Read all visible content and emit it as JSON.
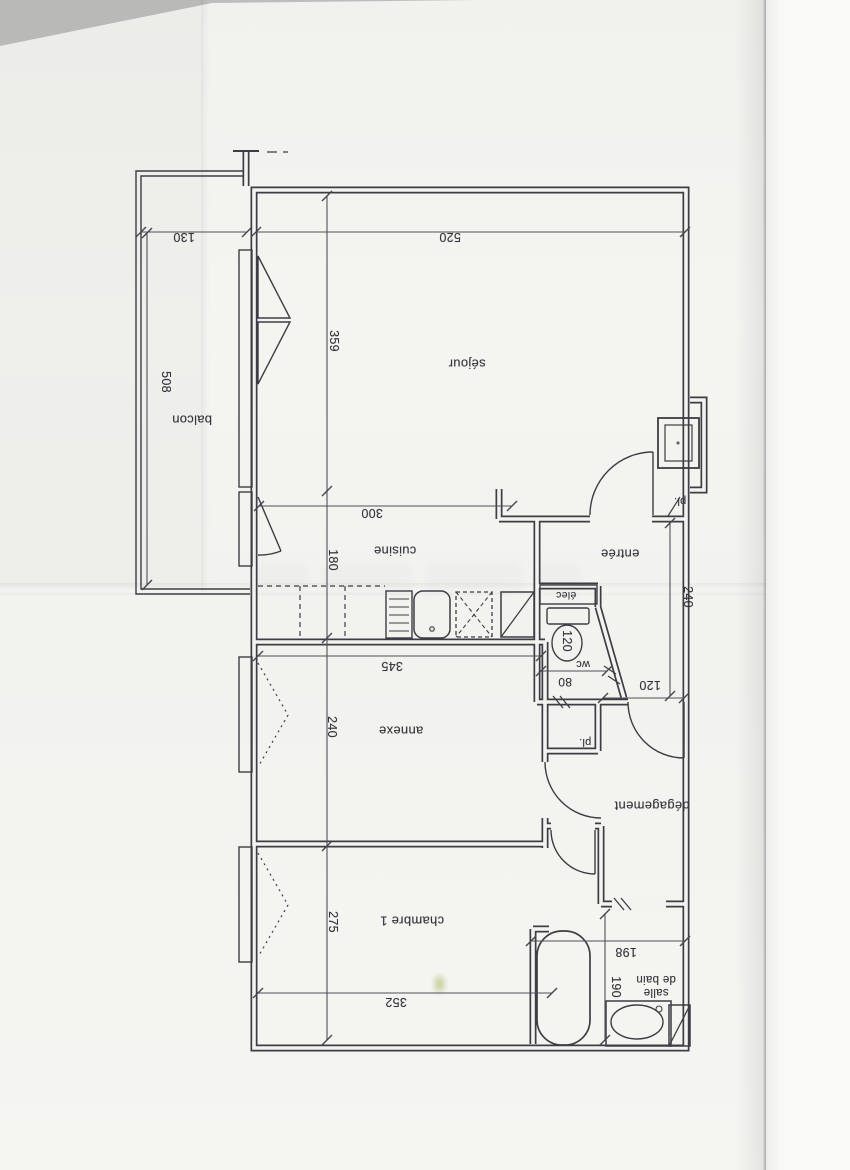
{
  "rooms": {
    "sejour": "séjour",
    "balcon": "balcon",
    "cuisine": "cuisine",
    "entree": "entrée",
    "annexe": "annexe",
    "degagement": "dégagement",
    "chambre1": "chambre 1",
    "salle_de_bain_line1": "salle",
    "salle_de_bain_line2": "de bain",
    "wc": "wc",
    "elec": "élec",
    "placard_entree": "pl.",
    "placard_annexe": "pl."
  },
  "dims": {
    "balcon_width": "130",
    "sejour_width": "520",
    "balcon_length": "508",
    "sejour_depth": "359",
    "cuisine_width": "300",
    "cuisine_depth": "180",
    "entree_depth": "240",
    "wc_length": "120",
    "wc_door": "80",
    "entree_width": "120",
    "annexe_width": "345",
    "annexe_depth": "240",
    "chambre_depth": "275",
    "chambre_width": "352",
    "sdb_width": "198",
    "sdb_depth": "190"
  },
  "colors": {
    "ink": "#3d3d45",
    "dim_ink": "#50505a",
    "paper": "#f3f3f0"
  }
}
